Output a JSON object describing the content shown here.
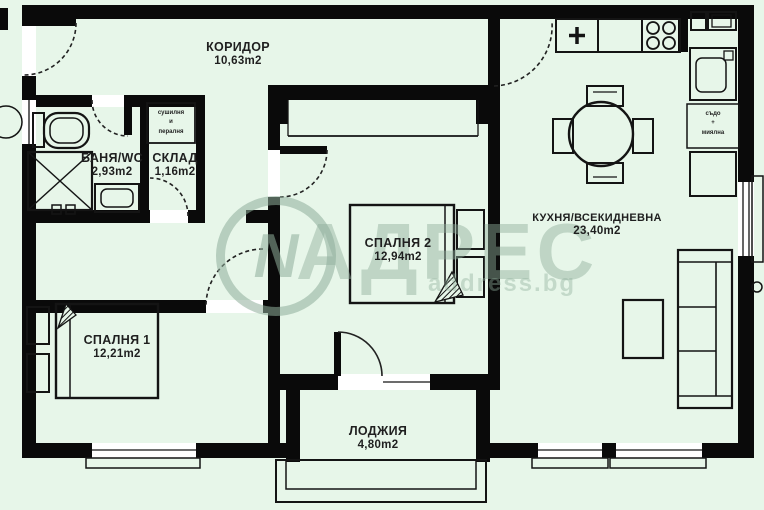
{
  "title": "Apartment floor plan",
  "watermark": {
    "logo_letter": "N",
    "brand": "АДРЕС",
    "subtext": "address.bg"
  },
  "rooms": [
    {
      "id": "koridor",
      "name": "КОРИДОР",
      "area": "10,63m2"
    },
    {
      "id": "banya",
      "name": "БАНЯ/WC",
      "area": "2,93m2"
    },
    {
      "id": "sklad",
      "name": "СКЛАД",
      "area": "1,16m2"
    },
    {
      "id": "spalnya2",
      "name": "СПАЛНЯ 2",
      "area": "12,94m2"
    },
    {
      "id": "spalnya1",
      "name": "СПАЛНЯ 1",
      "area": "12,21m2"
    },
    {
      "id": "kuhnya",
      "name": "КУХНЯ/ВСЕКИДНЕВНА",
      "area": "23,40m2"
    },
    {
      "id": "lodzhiya",
      "name": "ЛОДЖИЯ",
      "area": "4,80m2"
    }
  ],
  "annotations": {
    "laundry": {
      "line1": "сушилня",
      "line2": "и",
      "line3": "пералня"
    },
    "dishwasher": {
      "line1": "съдо",
      "line2": "+",
      "line3": "миялна"
    }
  },
  "colors": {
    "background": "#e7f6e9",
    "wall": "#0a0a0a",
    "thin_line": "#141414",
    "opening": "#ffffff",
    "watermark": "#8fae9b",
    "text": "#1f1f1f"
  }
}
